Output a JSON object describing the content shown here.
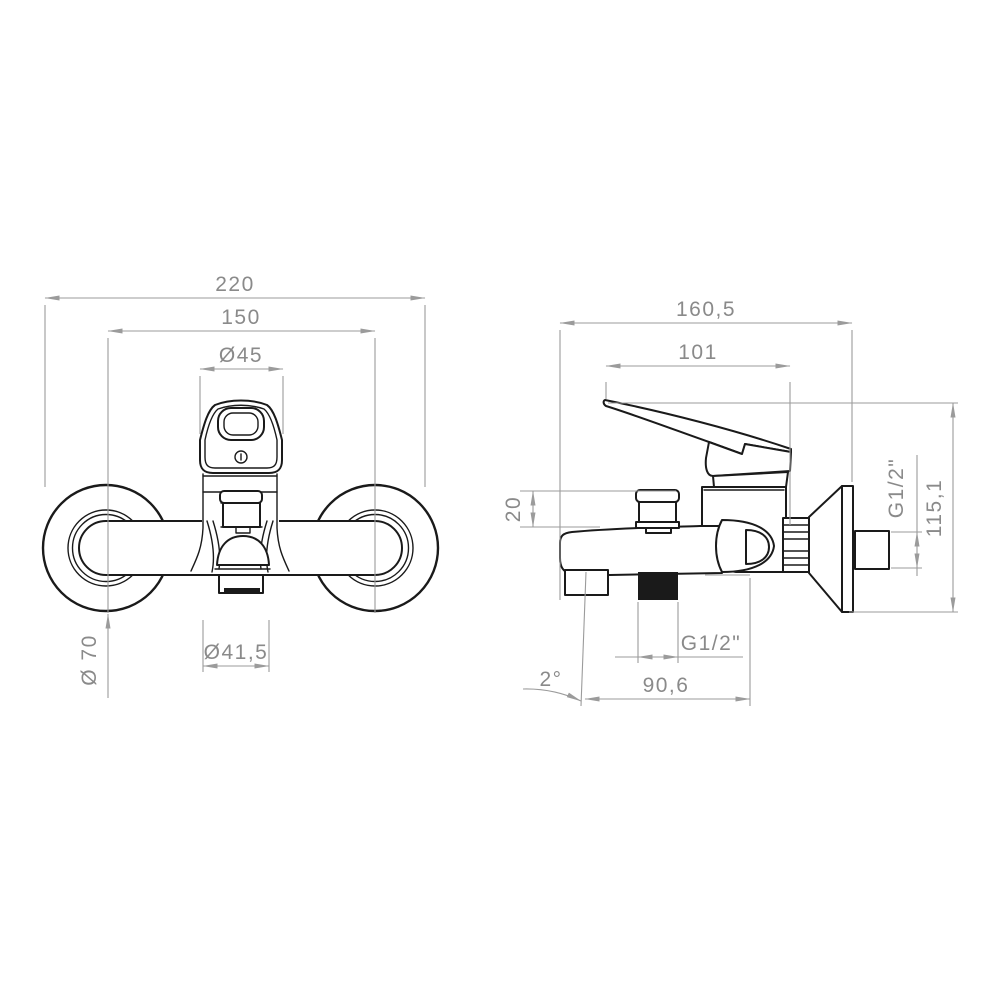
{
  "drawing": {
    "title": "Wall-mounted bath/shower mixer tap - dimensional technical drawing",
    "views": {
      "front": {
        "dims": {
          "overall_width": "220",
          "center_distance": "150",
          "handle_diameter": "Ø45",
          "flange_diameter": "Ø 70",
          "aerator_diameter": "Ø41,5"
        }
      },
      "side": {
        "dims": {
          "overall_depth": "160,5",
          "lever_length": "101",
          "diverter_height": "20",
          "wall_thread": "G1/2\"",
          "overall_height": "115,1",
          "hose_thread": "G1/2\"",
          "spout_reach": "90,6",
          "spout_angle": "2°"
        }
      }
    },
    "colors": {
      "outline": "#1a1a1a",
      "dimension_line": "#9b9b9b",
      "dimension_text": "#8a8a8a",
      "background": "#ffffff"
    }
  }
}
